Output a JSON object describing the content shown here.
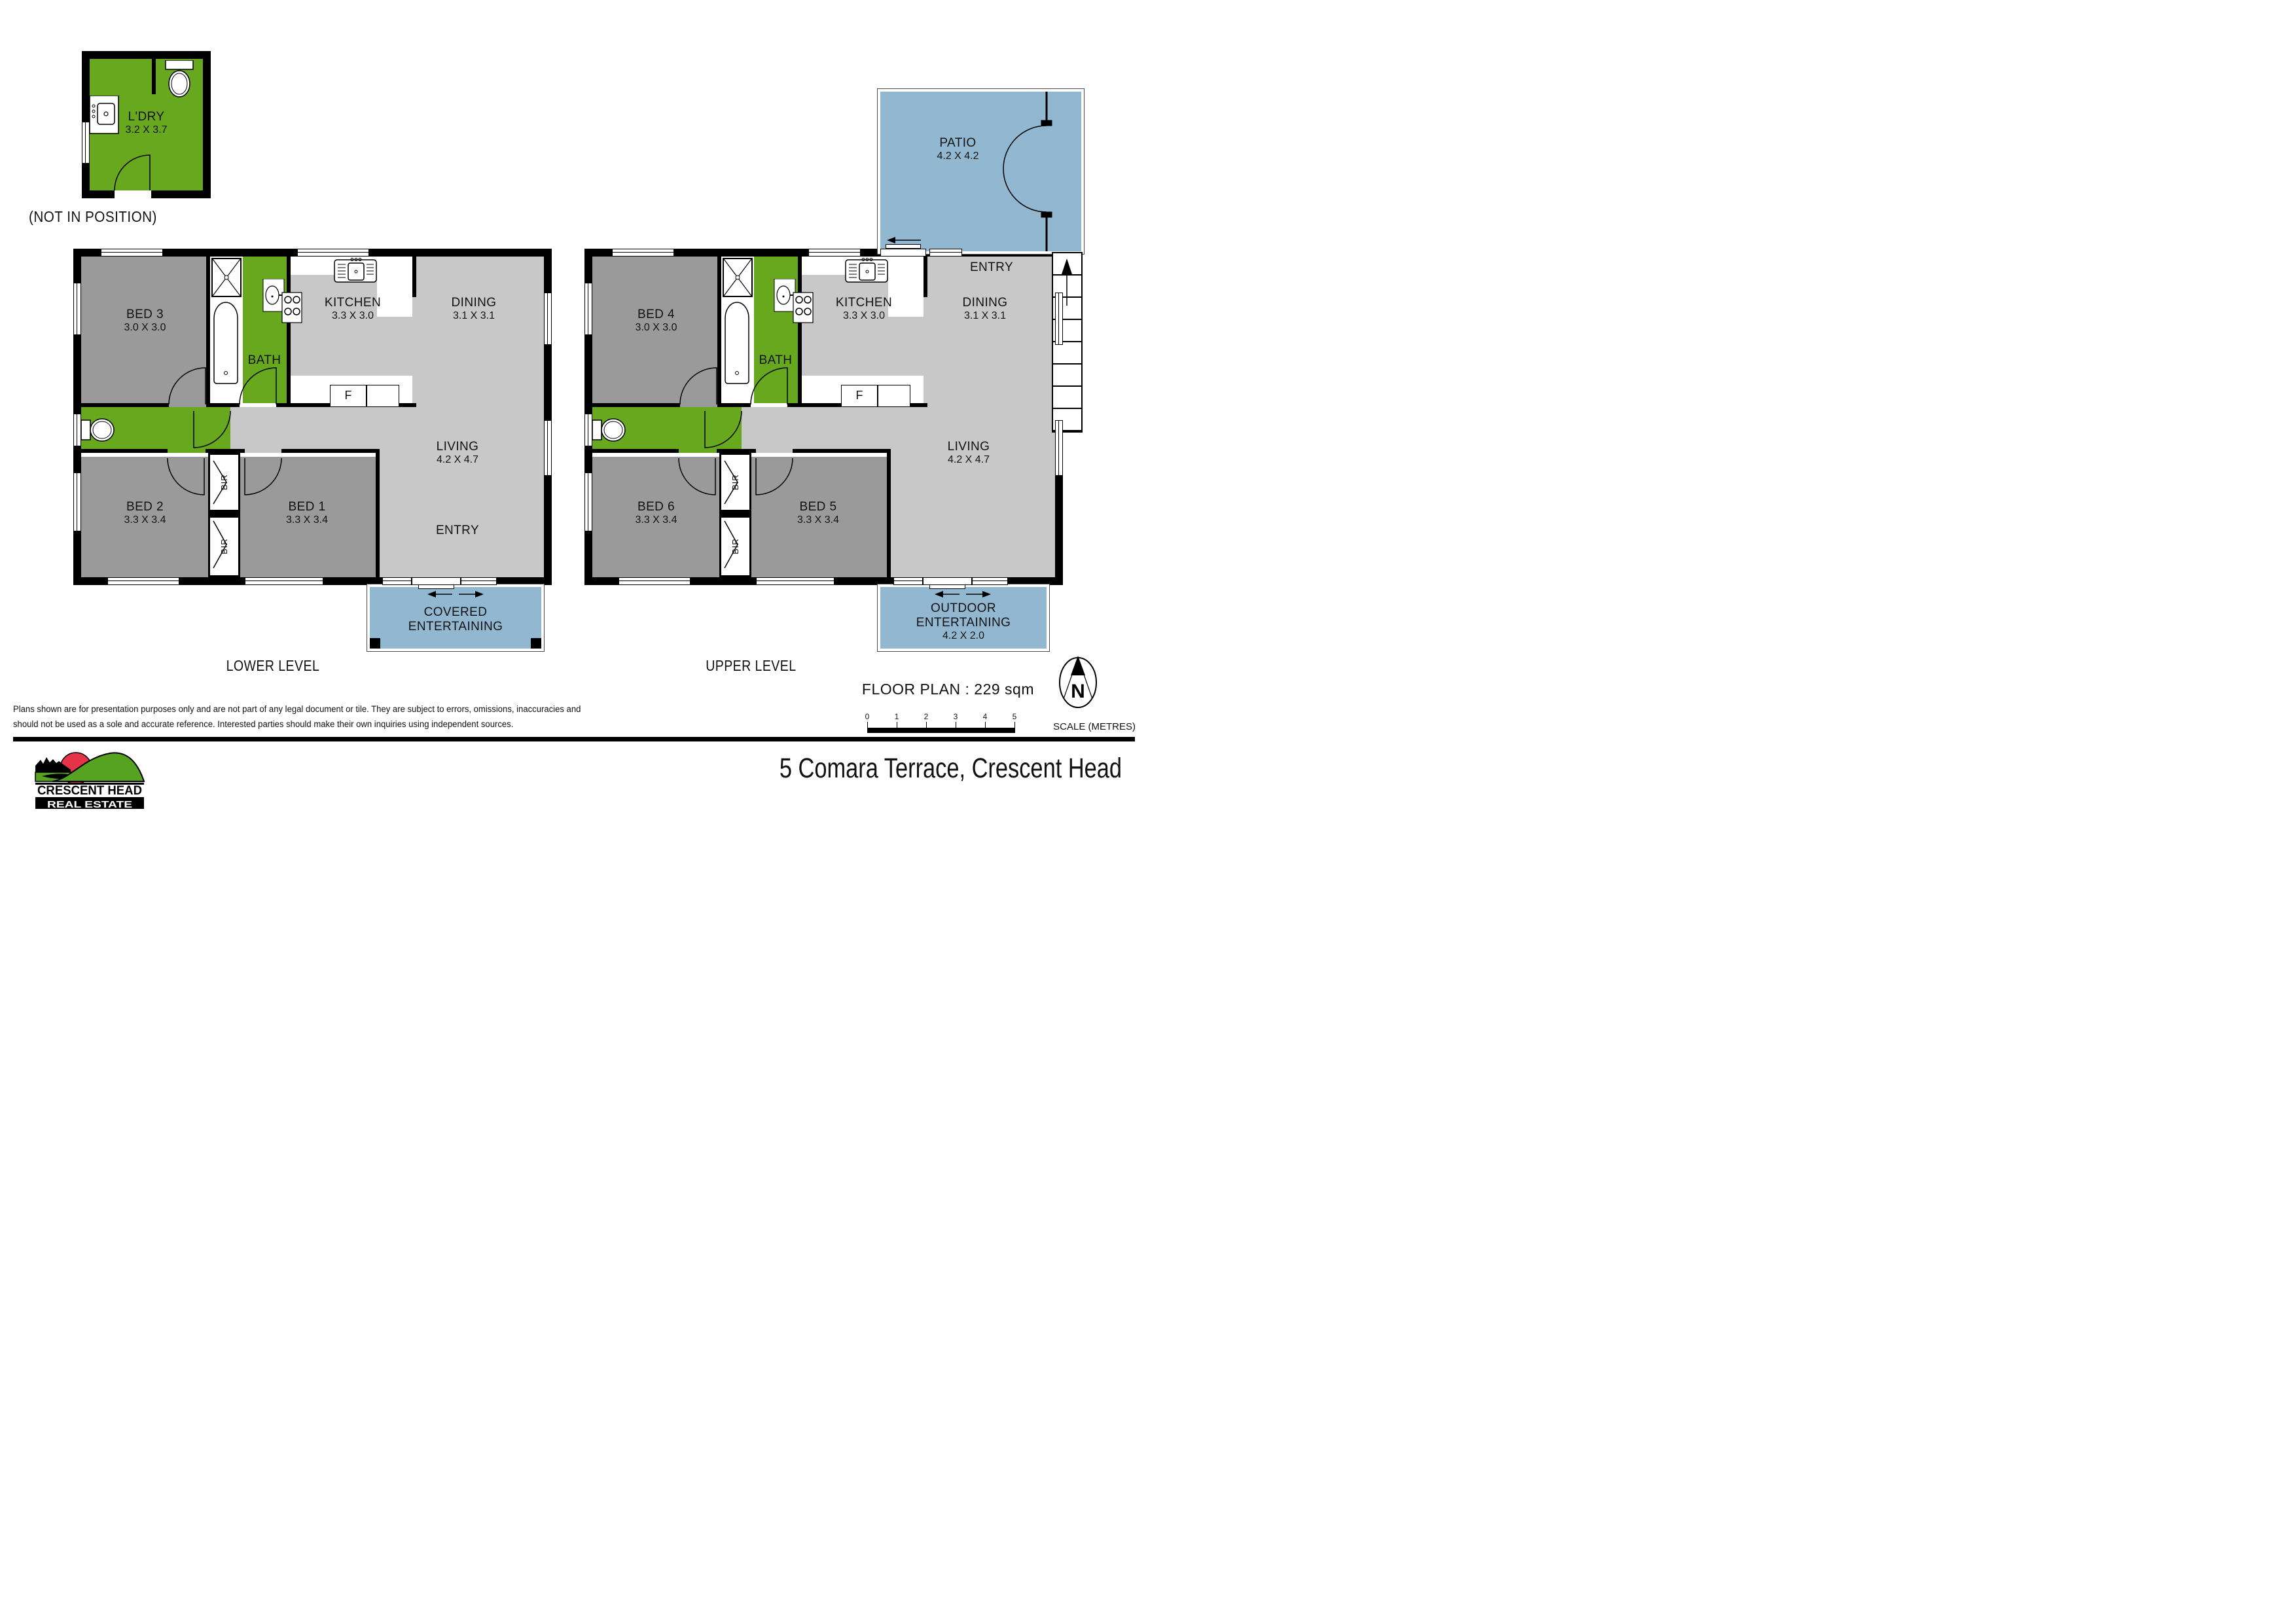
{
  "title": {
    "address": "5 Comara Terrace, Crescent Head"
  },
  "floor_plan_label": "FLOOR PLAN : 229 sqm",
  "scale": {
    "ticks": [
      "0",
      "1",
      "2",
      "3",
      "4",
      "5"
    ],
    "unit_label": "SCALE (METRES)"
  },
  "compass": {
    "letter": "N"
  },
  "disclaimer": {
    "line1": "Plans shown are for presentation purposes only and are not part of any legal document or tile. They are subject to errors, omissions, inaccuracies and",
    "line2": "should not be used as a sole and accurate reference. Interested parties should make their own inquiries using independent sources."
  },
  "logo": {
    "name_line1": "CRESCENT HEAD",
    "name_line2": "REAL ESTATE"
  },
  "laundry": {
    "name": "L'DRY",
    "dims": "3.2 X 3.7",
    "note": "(NOT IN POSITION)"
  },
  "lower": {
    "label": "LOWER LEVEL",
    "bed3": {
      "name": "BED 3",
      "dims": "3.0 X 3.0"
    },
    "bath": {
      "name": "BATH"
    },
    "kitchen": {
      "name": "KITCHEN",
      "dims": "3.3 X 3.0"
    },
    "dining": {
      "name": "DINING",
      "dims": "3.1 X 3.1"
    },
    "bed2": {
      "name": "BED 2",
      "dims": "3.3 X 3.4"
    },
    "bed1": {
      "name": "BED 1",
      "dims": "3.3 X 3.4"
    },
    "living": {
      "name": "LIVING",
      "dims": "4.2 X 4.7"
    },
    "entry": {
      "name": "ENTRY"
    },
    "fridge": "F",
    "bir": "BIR",
    "covered": {
      "line1": "COVERED",
      "line2": "ENTERTAINING"
    }
  },
  "upper": {
    "label": "UPPER LEVEL",
    "patio": {
      "name": "PATIO",
      "dims": "4.2 X 4.2"
    },
    "entry": {
      "name": "ENTRY"
    },
    "bed4": {
      "name": "BED 4",
      "dims": "3.0 X 3.0"
    },
    "bath": {
      "name": "BATH"
    },
    "kitchen": {
      "name": "KITCHEN",
      "dims": "3.3 X 3.0"
    },
    "dining": {
      "name": "DINING",
      "dims": "3.1 X 3.1"
    },
    "bed6": {
      "name": "BED 6",
      "dims": "3.3 X 3.4"
    },
    "bed5": {
      "name": "BED 5",
      "dims": "3.3 X 3.4"
    },
    "living": {
      "name": "LIVING",
      "dims": "4.2 X 4.7"
    },
    "fridge": "F",
    "bir": "BIR",
    "outdoor": {
      "line1": "OUTDOOR",
      "line2": "ENTERTAINING",
      "dims": "4.2 X 2.0"
    }
  },
  "colors": {
    "green": "#67a81f",
    "blue": "#92b7d0",
    "bedroom_gray": "#9a9a9a",
    "floor_gray": "#c8c8c8",
    "wall": "#000000",
    "logo_red": "#e5344a",
    "logo_green": "#55a321"
  }
}
